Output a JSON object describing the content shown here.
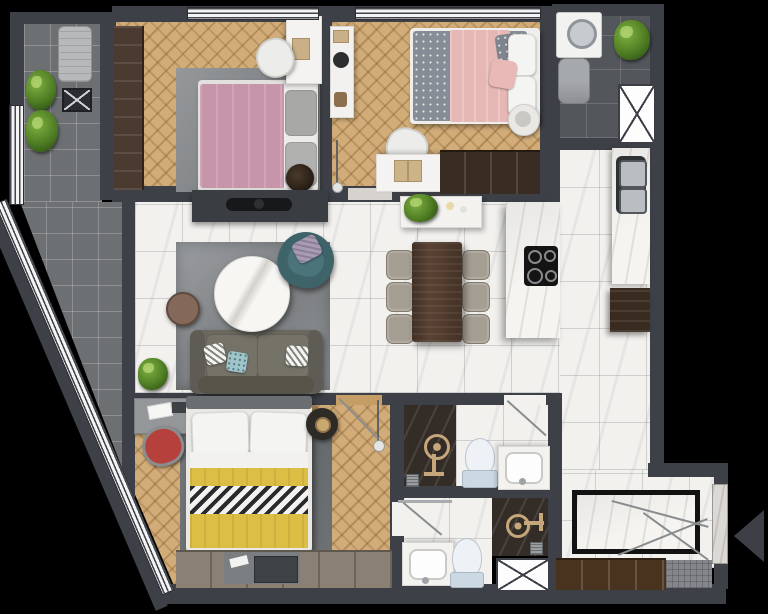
{
  "title": "Apartment floor plan — top-down 3D render, no text labels",
  "palette": {
    "background": "#000000",
    "wall": "#3d4046",
    "wood_floor": "#c59d66",
    "marble_floor": "#f2f1ee",
    "dark_marble": "#342d27",
    "balcony_tile_light": "#6d7073",
    "balcony_tile_dark": "#53565a",
    "bed_pink": "#c795a9",
    "bed_blanket_yellow": "#ddbe45",
    "armchair_teal": "#3e646a",
    "chair_red": "#b6413c",
    "dining_table_walnut": "#5a4233",
    "fixture_gold": "#c6a77b",
    "plant_green": "#4e7d23"
  },
  "rooms": [
    {
      "name": "balcony-left",
      "floor": "gray-tile",
      "items": [
        "plant",
        "plant",
        "ac-unit",
        "drain-box",
        "windows",
        "angled-window-wall"
      ]
    },
    {
      "name": "bedroom-1",
      "floor": "herringbone-wood",
      "items": [
        "tall-wardrobe",
        "desk",
        "chair",
        "double-bed-pink",
        "gray-pillows",
        "rug",
        "round-basket"
      ]
    },
    {
      "name": "bedroom-2",
      "floor": "herringbone-wood",
      "items": [
        "console-shelf",
        "double-bed-gray-dotted-pink-throw",
        "pouf",
        "desk",
        "chair",
        "wardrobe",
        "pendant-lamp"
      ]
    },
    {
      "name": "utility-balcony",
      "floor": "dark-tile",
      "items": [
        "washing-machine",
        "water-heater",
        "plant",
        "service-shaft"
      ]
    },
    {
      "name": "kitchen",
      "floor": "marble-tile",
      "items": [
        "island-counter",
        "cooktop-4-burner",
        "wall-counter",
        "double-sink",
        "fridge-cabinet"
      ]
    },
    {
      "name": "living-room",
      "floor": "marble-tile",
      "items": [
        "tv-console",
        "tv",
        "rug",
        "sofa",
        "cushions",
        "armchair-teal",
        "round-marble-coffee-table",
        "round-side-table",
        "plant"
      ]
    },
    {
      "name": "dining-area",
      "floor": "marble-tile",
      "items": [
        "dining-table",
        "chair",
        "chair",
        "chair",
        "chair",
        "chair",
        "chair",
        "console-table-with-flowers"
      ]
    },
    {
      "name": "bedroom-3",
      "floor": "herringbone-wood",
      "items": [
        "desk",
        "red-chair",
        "double-bed-yellow-chevron",
        "round-nightstand",
        "rug",
        "wardrobe-with-tv-unit",
        "pendant-lamp",
        "door-swing"
      ]
    },
    {
      "name": "bathroom-1",
      "floor": "marble + dark-marble shower",
      "items": [
        "shower-fixture",
        "floor-drain",
        "toilet",
        "vanity-sink",
        "door-swing"
      ]
    },
    {
      "name": "bathroom-2",
      "floor": "marble + dark-marble shower",
      "items": [
        "shower-rail",
        "shower-fixture",
        "vanity-sink",
        "toilet",
        "floor-drain",
        "service-shaft",
        "door-swing"
      ]
    },
    {
      "name": "foyer",
      "floor": "marble-tile",
      "items": [
        "inlay-entry-mat",
        "shoe-cabinet",
        "doormat",
        "entry-door",
        "door-swing-lines",
        "entry-direction-arrow"
      ]
    }
  ],
  "symbols": [
    "crossed-box-service-shaft",
    "window-glazing-strips",
    "door-swing-line",
    "entry-arrow-triangle"
  ]
}
